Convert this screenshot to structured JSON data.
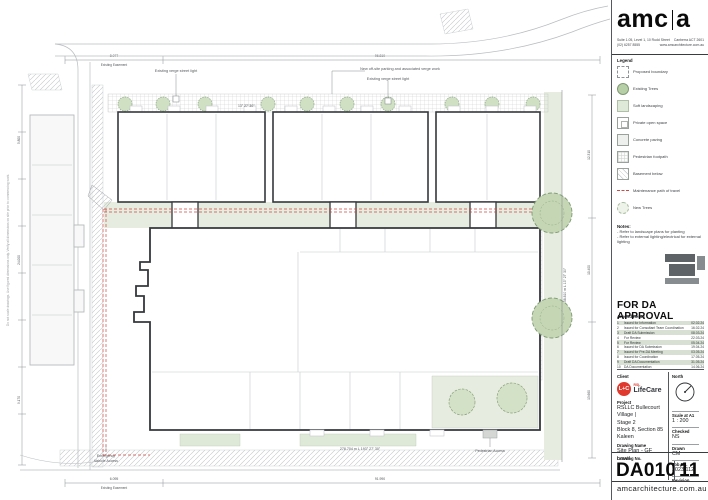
{
  "titleblock": {
    "logo": {
      "part1": "amc",
      "part2": "a"
    },
    "contact": {
      "address": "Suite 1.05, Level 1, 10 Rudd Street",
      "city": "Canberra ACT 2601",
      "phone": "(02) 6257 8555",
      "web": "www.amcarchitecture.com.au"
    },
    "legend": {
      "title": "Legend",
      "items": [
        {
          "label": "Proposed boundary"
        },
        {
          "label": "Existing Trees"
        },
        {
          "label": "Soft landscaping"
        },
        {
          "label": "Private open space"
        },
        {
          "label": "Concrete paving"
        },
        {
          "label": "Pedestrian footpath"
        },
        {
          "label": "Basement below"
        },
        {
          "label": "Maintenance path of travel"
        },
        {
          "label": "New Trees"
        }
      ]
    },
    "notes": {
      "title": "Notes:",
      "items": [
        "-  Refer to landscape plans for planting",
        "-  Refer to external lighting/electrical for external lighting"
      ]
    },
    "approval": "FOR DA APPROVAL",
    "amendments": {
      "title": "Amendments",
      "rows": [
        {
          "no": "1",
          "desc": "Issued for Information",
          "date": "02.02.24"
        },
        {
          "no": "2",
          "desc": "Issued for Consultant Team Coordination",
          "date": "16.02.24"
        },
        {
          "no": "3",
          "desc": "Draft DA Submission",
          "date": "08.03.24"
        },
        {
          "no": "4",
          "desc": "For Review",
          "date": "22.03.24"
        },
        {
          "no": "5",
          "desc": "For Review",
          "date": "05.04.24"
        },
        {
          "no": "6",
          "desc": "Issued for DA Submission",
          "date": "19.04.24"
        },
        {
          "no": "7",
          "desc": "Issued for Pre-DA Meeting",
          "date": "03.05.24"
        },
        {
          "no": "8",
          "desc": "Issued for Coordination",
          "date": "17.05.24"
        },
        {
          "no": "9",
          "desc": "Draft DA Documentation",
          "date": "31.05.24"
        },
        {
          "no": "10",
          "desc": "DA Documentation",
          "date": "14.06.24"
        }
      ]
    },
    "client": {
      "label": "Client",
      "badge": "L+C",
      "brand_top": "RSL",
      "brand": "LifeCare"
    },
    "north_label": "North",
    "project": {
      "label": "Project",
      "line1": "RSLLC Bullecourt Village |",
      "line2": "Stage 2",
      "line3": "Block 8, Section 85",
      "line4": "Kaleen"
    },
    "drawing_name": {
      "label": "Drawing Name",
      "value": "Site Plan - GF Level"
    },
    "meta": {
      "scale_label": "Scale at A1",
      "scale": "1 : 200",
      "checked_label": "Checked",
      "checked": "NS",
      "drawn_label": "Drawn",
      "drawn": "CM",
      "job_label": "Job No.",
      "job": "2023.112",
      "revision_label": "Revision"
    },
    "drawing_no": {
      "label": "Drawing No.",
      "value": "DA010",
      "revision": "11"
    },
    "footer": "amcarchitecture.com.au"
  },
  "plan": {
    "labels": {
      "street_light_1": "Existing verge street light",
      "street_light_2": "Existing verge street light",
      "new_parking": "New off-site parking and associated verge work",
      "bearing_top": "13° 27' 30\"",
      "bearing_right": "58.810 m L 13° 27' 30\"",
      "bearing_bottom": "278.704 m L 193° 27' 30\"",
      "emergency_1": "Emergency",
      "emergency_2": "Vehicle Access",
      "pedestrian": "Pedestrian Access",
      "dim_top_a": "8.077",
      "dim_top_a_sub": "Existing Easement",
      "dim_top_b": "96.810",
      "dim_bottom_a": "6.095",
      "dim_bottom_a_sub": "Existing Easement",
      "dim_bottom_b": "91.990",
      "dim_left_a": "5.800",
      "dim_left_b": "24.000",
      "dim_left_c": "9.170",
      "dim_right_a": "12.310",
      "dim_right_b": "10.400",
      "dim_right_c": "13.660",
      "margin_note": "Do not scale drawings. Use figured dimensions only. Verify all dimensions on site prior to commencing work."
    },
    "colors": {
      "maintenance_red": "#cc4a44",
      "tree_green": "#c4d6b4",
      "landscape_green": "#e6ecdf",
      "building_ink": "#34373c"
    }
  }
}
